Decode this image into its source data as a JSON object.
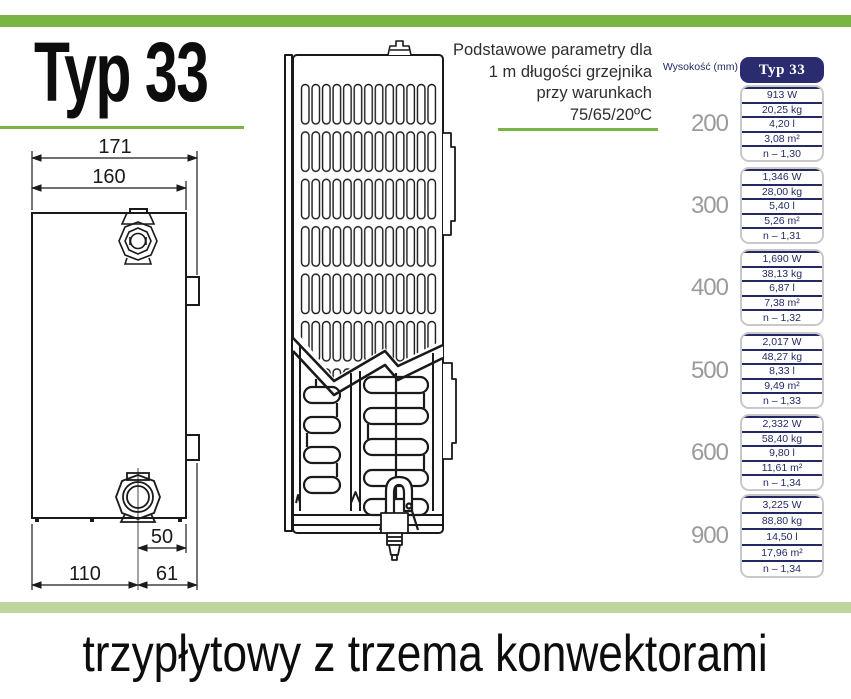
{
  "colors": {
    "accent_green": "#7ab544",
    "light_green_band": "#bed69c",
    "navy": "#2b2b70",
    "navy_text": "#232a63",
    "gray_height_label": "#9b9b9b"
  },
  "header": {
    "title": "Typ 33",
    "params_note": [
      "Podstawowe parametry dla",
      "1 m długości grzejnika",
      "przy warunkach",
      "75/65/20ºC"
    ]
  },
  "drawing": {
    "dims": {
      "total_width": "171",
      "body_width": "160",
      "offset_right": "50",
      "offset_left": "110",
      "offset_bracket": "61"
    }
  },
  "table": {
    "height_header": "Wysokość (mm)",
    "type_header": "Typ 33",
    "groups": [
      {
        "height": "200",
        "values": [
          "913 W",
          "20,25 kg",
          "4,20 l",
          "3,08 m²",
          "n – 1,30"
        ]
      },
      {
        "height": "300",
        "values": [
          "1,346 W",
          "28,00 kg",
          "5,40 l",
          "5,26 m²",
          "n – 1,31"
        ]
      },
      {
        "height": "400",
        "values": [
          "1,690 W",
          "38,13 kg",
          "6,87 l",
          "7,38 m²",
          "n – 1,32"
        ]
      },
      {
        "height": "500",
        "values": [
          "2,017 W",
          "48,27 kg",
          "8,33 l",
          "9,49 m²",
          "n – 1,33"
        ]
      },
      {
        "height": "600",
        "values": [
          "2,332 W",
          "58,40 kg",
          "9,80 l",
          "11,61 m²",
          "n – 1,34"
        ]
      },
      {
        "height": "900",
        "values": [
          "3,225 W",
          "88,80 kg",
          "14,50 l",
          "17,96 m²",
          "n – 1,34"
        ]
      }
    ]
  },
  "footer": {
    "caption": "trzypłytowy z trzema konwektorami"
  }
}
